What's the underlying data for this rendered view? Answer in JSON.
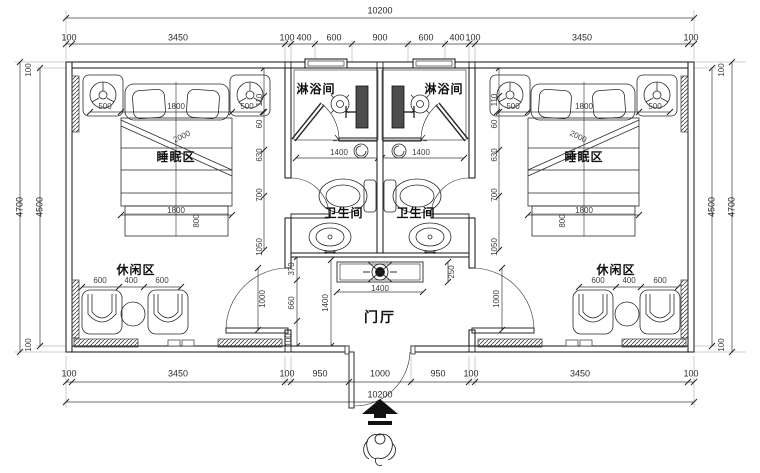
{
  "labels": {
    "sleep": "睡眠区",
    "shower": "淋浴间",
    "toilet": "卫生间",
    "leisure": "休闲区",
    "hall": "门厅"
  },
  "dims": {
    "overall": "10200",
    "top_row": [
      "100",
      "3450",
      "100",
      "400",
      "600",
      "900",
      "600",
      "400",
      "100",
      "3450",
      "100"
    ],
    "bottom_row": [
      "100",
      "3450",
      "100",
      "950",
      "1000",
      "950",
      "100",
      "3450",
      "100"
    ],
    "height_outer": "4700",
    "height_inner": "4500",
    "wall": "100",
    "bed_side": "500",
    "bed_width": "1800",
    "bed_diag": "2000",
    "bed_foot": "1800",
    "bed_foot_depth": "800",
    "stack": [
      "110",
      "60",
      "630",
      "700",
      "1050"
    ],
    "leisure_row": [
      "600",
      "400",
      "600"
    ],
    "bath_width": "1400",
    "console_width": "1400",
    "console_depth": "250",
    "hall_depth": "1400",
    "hall_stack": [
      "370",
      "660",
      "100"
    ],
    "door_width": "1000"
  },
  "colors": {
    "ink": "#1a1a1a",
    "dim_text": "#3d3d3d",
    "paper": "#ffffff"
  }
}
